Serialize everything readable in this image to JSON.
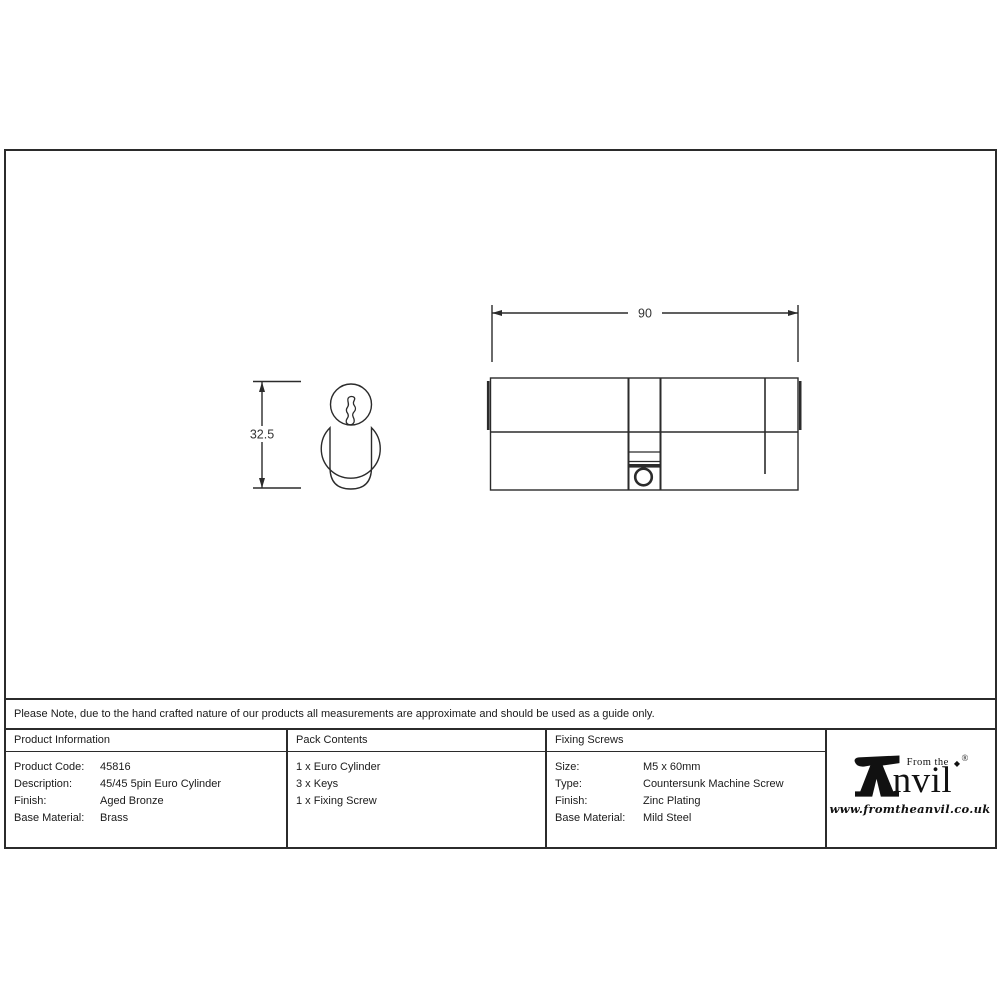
{
  "colors": {
    "line": "#2b2b2b",
    "text": "#1a1a1a"
  },
  "drawing": {
    "front_view_height_label": "32.5",
    "side_view_width_label": "90"
  },
  "note": {
    "text": "Please Note, due to the hand crafted nature of our products all measurements are approximate and should be used as a guide only."
  },
  "table": {
    "product_information": {
      "header": "Product Information",
      "rows": [
        {
          "label": "Product Code:",
          "value": "45816"
        },
        {
          "label": "Description:",
          "value": "45/45 5pin Euro Cylinder"
        },
        {
          "label": "Finish:",
          "value": "Aged Bronze"
        },
        {
          "label": "Base Material:",
          "value": "Brass"
        }
      ]
    },
    "pack_contents": {
      "header": "Pack Contents",
      "items": [
        "1 x Euro Cylinder",
        "3 x Keys",
        "1 x Fixing Screw"
      ]
    },
    "fixing_screws": {
      "header": "Fixing Screws",
      "rows": [
        {
          "label": "Size:",
          "value": "M5 x 60mm"
        },
        {
          "label": "Type:",
          "value": "Countersunk Machine Screw"
        },
        {
          "label": "Finish:",
          "value": "Zinc Plating"
        },
        {
          "label": "Base Material:",
          "value": "Mild Steel"
        }
      ]
    }
  },
  "brand": {
    "from_the": "From the",
    "diamond_dot": "◆",
    "wordmark_rest": "nvil",
    "registered": "®",
    "website": "www.fromtheanvil.co.uk"
  }
}
